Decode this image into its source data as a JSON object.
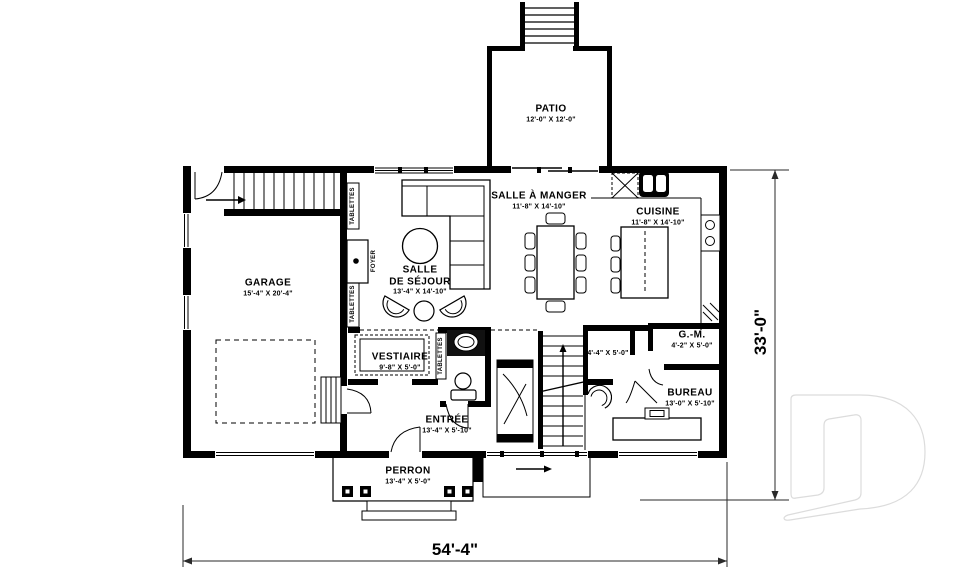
{
  "plan": {
    "rooms": {
      "patio": {
        "name": "PATIO",
        "dims": "12'-0\" X 12'-0\""
      },
      "salle_a_manger": {
        "name": "SALLE À MANGER",
        "dims": "11'-8\" X 14'-10\""
      },
      "cuisine": {
        "name": "CUISINE",
        "dims": "11'-8\" X 14'-10\""
      },
      "garage": {
        "name": "GARAGE",
        "dims": "15'-4\" X 20'-4\""
      },
      "salle_de_sejour": {
        "name": "SALLE DE SÉJOUR",
        "name_lines": [
          "SALLE",
          "DE SÉJOUR"
        ],
        "dims": "13'-4\" X 14'-10\""
      },
      "vestiaire": {
        "name": "VESTIAIRE",
        "dims": "9'-8\" X 5'-0\""
      },
      "entree": {
        "name": "ENTRÉE",
        "dims": "13'-4\" X 5'-10\""
      },
      "bureau": {
        "name": "BUREAU",
        "dims": "13'-0\" X 5'-10\""
      },
      "garde_manger": {
        "name": "G.-M.",
        "dims": "4'-2\" X 5'-0\""
      },
      "closet": {
        "dims": "4'-4\" X 5'-0\""
      },
      "perron": {
        "name": "PERRON",
        "dims": "13'-4\" X 5'-0\""
      }
    },
    "annotations": {
      "tablettes": "TABLETTES",
      "foyer": "FOYER"
    },
    "overall_dimensions": {
      "width": "54'-4\"",
      "height": "33'-0\""
    },
    "watermark_letter": "D",
    "colors": {
      "ink": "#000000",
      "dimension": "#2a2a2a",
      "watermark": "#dcdcdc",
      "background": "#ffffff"
    }
  }
}
